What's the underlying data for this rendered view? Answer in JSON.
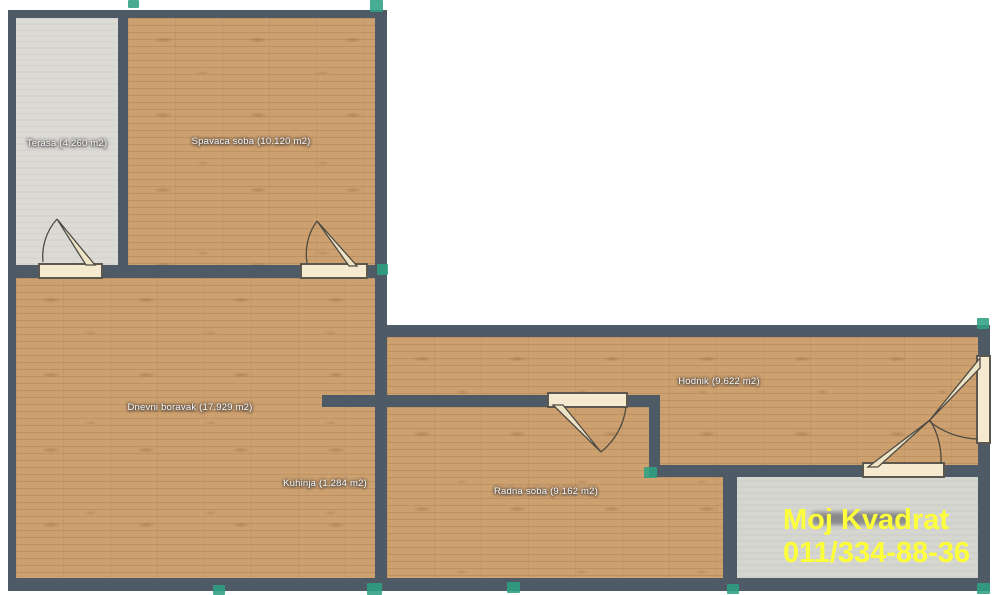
{
  "rooms": {
    "terasa": {
      "label": "Terasa (4.260 m2)"
    },
    "spavaca_soba": {
      "label": "Spavaca soba (10.120 m2)"
    },
    "dnevni_boravak": {
      "label": "Dnevni boravak (17.929 m2)"
    },
    "kuhinja": {
      "label": "Kuhinja (1.284 m2)"
    },
    "hodnik": {
      "label": "Hodnik (9.622 m2)"
    },
    "radna_soba": {
      "label": "Radna soba (9.162 m2)"
    }
  },
  "watermark": {
    "line1": "Moj Kvadrat",
    "line2": "011/334-88-36"
  },
  "colors": {
    "wall": "#4e5a65",
    "wood_floor": "#cda06f",
    "gray_floor": "#dbdad5",
    "handle_green": "#2da183",
    "door_fill": "#f5ead0",
    "watermark_yellow": "#fdff3b"
  }
}
